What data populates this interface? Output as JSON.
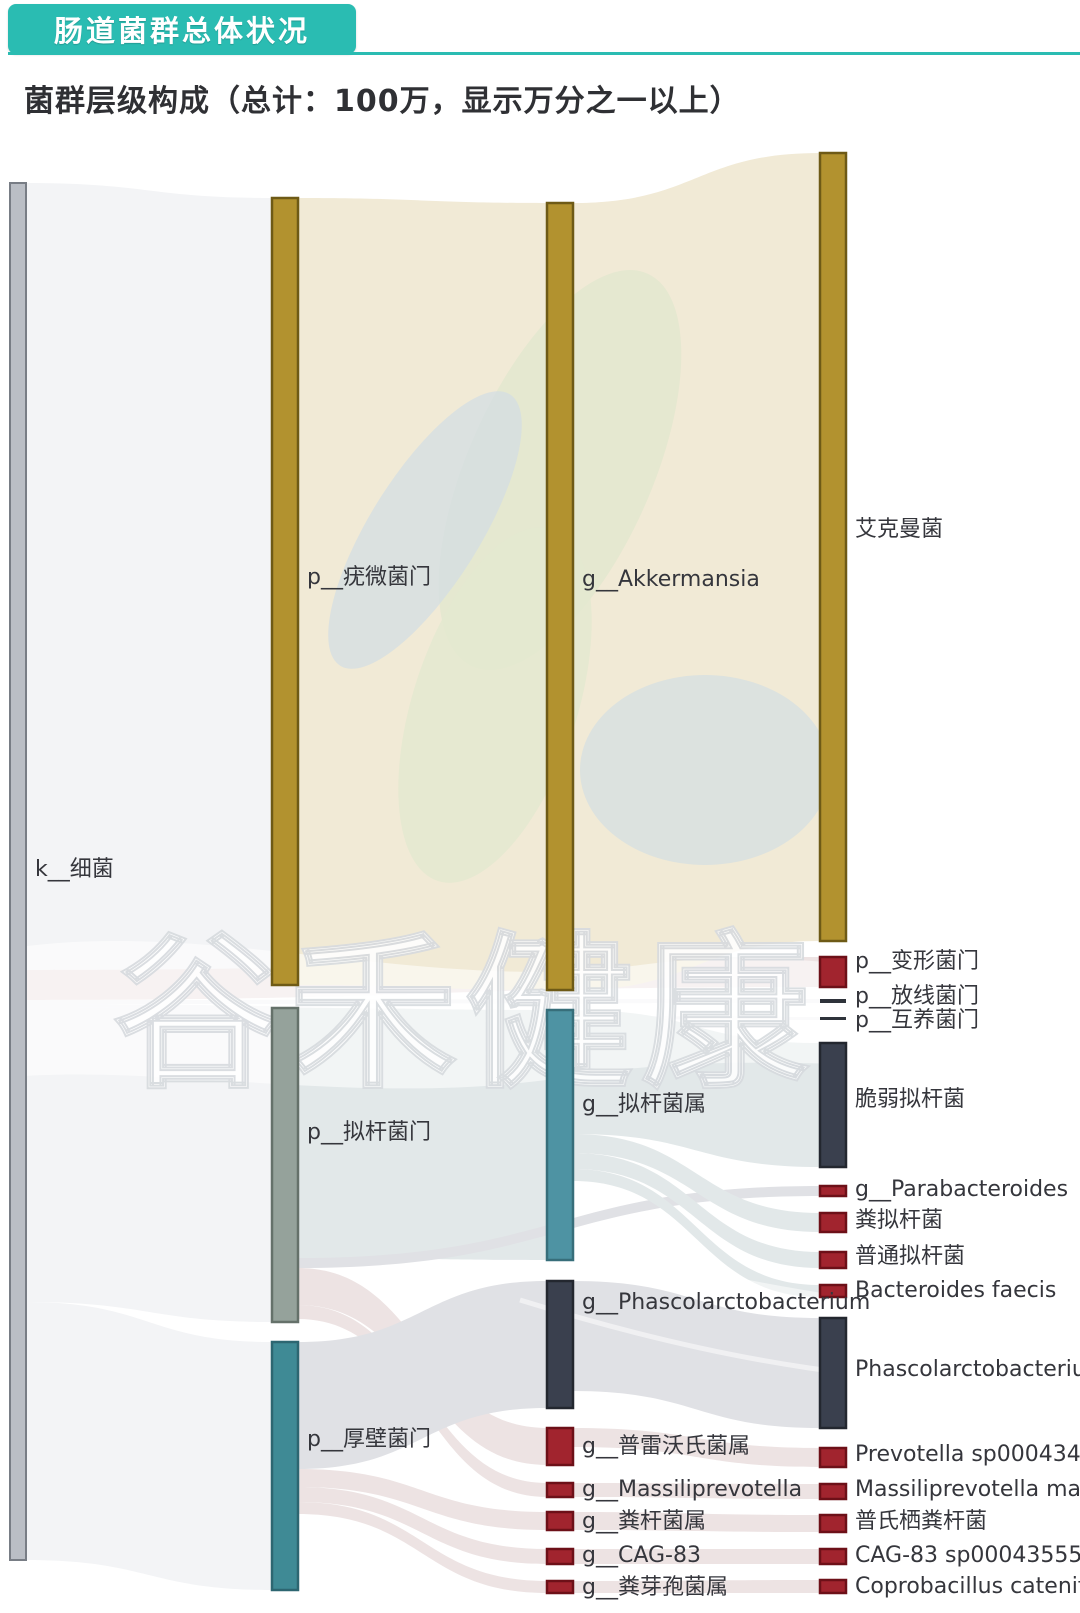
{
  "header": {
    "tab_title": "肠道菌群总体状况",
    "subtitle": "菌群层级构成（总计：100万，显示万分之一以上）"
  },
  "watermark": {
    "text": "谷禾健康"
  },
  "brand": {
    "teal": "#2abcb2",
    "gold": "#b2922f",
    "red": "#a1242e",
    "dark": "#3a404e"
  },
  "chart_data": {
    "type": "sankey",
    "title": "菌群层级构成（总计：100万，显示万分之一以上）",
    "total_label": "总计：100万",
    "threshold_label": "显示万分之一以上",
    "levels": [
      "kingdom",
      "phylum",
      "genus",
      "species"
    ],
    "palette": {
      "gray": "#babec5",
      "gray_stroke": "#787d85",
      "gold": "#b2922f",
      "gold_stroke": "#6e5a16",
      "sage": "#95a29b",
      "sage_stroke": "#65716a",
      "teal": "#3f8a95",
      "teal_stroke": "#2d6671",
      "teal2": "#4e93a3",
      "teal2_stroke": "#376e7a",
      "dark": "#3a404e",
      "dark_stroke": "#23272f",
      "red": "#a1242e",
      "red_stroke": "#6d1018",
      "darkline": "#2f333b",
      "flowGray": "#f3f4f6",
      "beige": "#f1ead6",
      "flowTeal": "#e2e8e9",
      "flowPink": "#ede3e3",
      "flowDark": "#e0e1e5"
    },
    "layout": {
      "columns": [
        {
          "x": 10,
          "w": 16
        },
        {
          "x": 272,
          "w": 26
        },
        {
          "x": 547,
          "w": 26
        },
        {
          "x": 820,
          "w": 26
        }
      ]
    },
    "nodes": [
      {
        "id": "k_bacteria",
        "label": "k__细菌",
        "col": 1,
        "y0": 183,
        "y1": 1560,
        "ly": 870,
        "color": "gray",
        "approx_share_pct": 100
      },
      {
        "id": "p_verruco",
        "label": "p__疣微菌门",
        "col": 2,
        "y0": 198,
        "y1": 985,
        "ly": 578,
        "color": "gold",
        "approx_share_pct": 57
      },
      {
        "id": "p_bacteroidetes",
        "label": "p__拟杆菌门",
        "col": 2,
        "y0": 1008,
        "y1": 1322,
        "ly": 1133,
        "color": "sage",
        "approx_share_pct": 23
      },
      {
        "id": "p_firmicutes",
        "label": "p__厚壁菌门",
        "col": 2,
        "y0": 1342,
        "y1": 1590,
        "ly": 1440,
        "color": "teal",
        "approx_share_pct": 18
      },
      {
        "id": "g_akkermansia",
        "label": "g__Akkermansia",
        "col": 3,
        "y0": 203,
        "y1": 990,
        "ly": 580,
        "color": "gold",
        "approx_share_pct": 57
      },
      {
        "id": "g_bacteroides",
        "label": "g__拟杆菌属",
        "col": 3,
        "y0": 1010,
        "y1": 1260,
        "ly": 1105,
        "color": "teal2",
        "approx_share_pct": 18
      },
      {
        "id": "g_phascolarcto",
        "label": "g__Phascolarctobacterium",
        "col": 3,
        "y0": 1281,
        "y1": 1408,
        "ly": 1303,
        "color": "dark",
        "approx_share_pct": 9.2
      },
      {
        "id": "g_prevotella",
        "label": "g__普雷沃氏菌属",
        "col": 3,
        "y0": 1428,
        "y1": 1465,
        "ly": 1447,
        "color": "red",
        "approx_share_pct": 2.7
      },
      {
        "id": "g_massiliprevotella",
        "label": "g__Massiliprevotella",
        "col": 3,
        "y0": 1483,
        "y1": 1497,
        "ly": 1490,
        "color": "red",
        "approx_share_pct": 1.0
      },
      {
        "id": "g_faecalibacterium",
        "label": "g__粪杆菌属",
        "col": 3,
        "y0": 1512,
        "y1": 1530,
        "ly": 1522,
        "color": "red",
        "approx_share_pct": 1.3
      },
      {
        "id": "g_cag83",
        "label": "g__CAG-83",
        "col": 3,
        "y0": 1549,
        "y1": 1564,
        "ly": 1556,
        "color": "red",
        "approx_share_pct": 1.1
      },
      {
        "id": "g_coprobacillus",
        "label": "g__粪芽孢菌属",
        "col": 3,
        "y0": 1581,
        "y1": 1593,
        "ly": 1588,
        "color": "red",
        "approx_share_pct": 0.9
      },
      {
        "id": "s_akkermansia",
        "label": "艾克曼菌",
        "col": 4,
        "y0": 153,
        "y1": 941,
        "ly": 530,
        "color": "gold",
        "approx_share_pct": 57
      },
      {
        "id": "p_proteobacteria",
        "label": "p__变形菌门",
        "col": 4,
        "y0": 957,
        "y1": 987,
        "ly": 962,
        "color": "red",
        "approx_share_pct": 2.2
      },
      {
        "id": "p_actinobacteria",
        "label": "p__放线菌门",
        "col": 4,
        "y0": 999,
        "y1": 1003,
        "ly": 997,
        "color": "darkline",
        "approx_share_pct": 0.3
      },
      {
        "id": "p_synergistetes",
        "label": "p__互养菌门",
        "col": 4,
        "y0": 1017,
        "y1": 1020,
        "ly": 1021,
        "color": "darkline",
        "approx_share_pct": 0.2
      },
      {
        "id": "s_fragilis",
        "label": "脆弱拟杆菌",
        "col": 4,
        "y0": 1043,
        "y1": 1167,
        "ly": 1100,
        "color": "dark",
        "approx_share_pct": 9
      },
      {
        "id": "g_parabacteroides",
        "label": "g__Parabacteroides",
        "col": 4,
        "y0": 1186,
        "y1": 1196,
        "ly": 1190,
        "color": "red",
        "approx_share_pct": 0.7
      },
      {
        "id": "s_caccae",
        "label": "粪拟杆菌",
        "col": 4,
        "y0": 1213,
        "y1": 1232,
        "ly": 1221,
        "color": "red",
        "approx_share_pct": 1.4
      },
      {
        "id": "s_vulgatus",
        "label": "普通拟杆菌",
        "col": 4,
        "y0": 1252,
        "y1": 1268,
        "ly": 1257,
        "color": "red",
        "approx_share_pct": 1.2
      },
      {
        "id": "s_faecis",
        "label": "Bacteroides faecis",
        "col": 4,
        "y0": 1285,
        "y1": 1297,
        "ly": 1291,
        "color": "red",
        "approx_share_pct": 0.9
      },
      {
        "id": "s_phascolarcto",
        "label": "Phascolarctobacteriu",
        "col": 4,
        "y0": 1318,
        "y1": 1428,
        "ly": 1370,
        "color": "dark",
        "approx_share_pct": 8
      },
      {
        "id": "s_prevotella_sp",
        "label": "Prevotella sp0004349",
        "col": 4,
        "y0": 1448,
        "y1": 1467,
        "ly": 1455,
        "color": "red",
        "approx_share_pct": 1.4
      },
      {
        "id": "s_massiliprevotella",
        "label": "Massiliprevotella mas",
        "col": 4,
        "y0": 1484,
        "y1": 1499,
        "ly": 1490,
        "color": "red",
        "approx_share_pct": 1.1
      },
      {
        "id": "s_prausnitzii",
        "label": "普氏栖粪杆菌",
        "col": 4,
        "y0": 1515,
        "y1": 1532,
        "ly": 1522,
        "color": "red",
        "approx_share_pct": 1.2
      },
      {
        "id": "s_cag83_sp",
        "label": "CAG-83 sp00043555",
        "col": 4,
        "y0": 1549,
        "y1": 1564,
        "ly": 1556,
        "color": "red",
        "approx_share_pct": 1.1
      },
      {
        "id": "s_coprobacillus",
        "label": "Coprobacillus catenif",
        "col": 4,
        "y0": 1580,
        "y1": 1593,
        "ly": 1587,
        "color": "red",
        "approx_share_pct": 0.9
      }
    ],
    "links": [
      {
        "source": "k_bacteria",
        "target": "p_verruco",
        "s0": 183,
        "s1": 970,
        "t0": 198,
        "t1": 985,
        "color": "flowGray"
      },
      {
        "source": "k_bacteria",
        "target": "p_proteobacteria",
        "s0": 970,
        "s1": 1000,
        "t0": 957,
        "t1": 987,
        "color": "flowPink"
      },
      {
        "source": "k_bacteria",
        "target": "p_actinobacteria",
        "s0": 1000,
        "s1": 1004,
        "t0": 999,
        "t1": 1003,
        "color": "flowGray"
      },
      {
        "source": "k_bacteria",
        "target": "p_synergistetes",
        "s0": 1004,
        "s1": 1007,
        "t0": 1017,
        "t1": 1020,
        "color": "flowGray"
      },
      {
        "source": "k_bacteria",
        "target": "p_bacteroidetes",
        "s0": 1007,
        "s1": 1302,
        "t0": 1008,
        "t1": 1322,
        "color": "flowGray"
      },
      {
        "source": "k_bacteria",
        "target": "p_firmicutes",
        "s0": 1302,
        "s1": 1560,
        "t0": 1342,
        "t1": 1590,
        "color": "flowGray"
      },
      {
        "source": "p_verruco",
        "target": "g_akkermansia",
        "s0": 198,
        "s1": 985,
        "t0": 203,
        "t1": 990,
        "color": "beige"
      },
      {
        "source": "g_akkermansia",
        "target": "s_akkermansia",
        "s0": 203,
        "s1": 990,
        "t0": 153,
        "t1": 941,
        "color": "beige"
      },
      {
        "source": "p_bacteroidetes",
        "target": "g_bacteroides",
        "s0": 1008,
        "s1": 1258,
        "t0": 1010,
        "t1": 1260,
        "color": "flowTeal"
      },
      {
        "source": "p_bacteroidetes",
        "target": "g_parabacteroides",
        "s0": 1258,
        "s1": 1268,
        "t0": 1186,
        "t1": 1196,
        "color": "flowDark"
      },
      {
        "source": "p_bacteroidetes",
        "target": "g_prevotella",
        "s0": 1268,
        "s1": 1305,
        "t0": 1428,
        "t1": 1465,
        "color": "flowPink"
      },
      {
        "source": "p_bacteroidetes",
        "target": "g_massiliprevotella",
        "s0": 1305,
        "s1": 1319,
        "t0": 1483,
        "t1": 1497,
        "color": "flowPink"
      },
      {
        "source": "p_firmicutes",
        "target": "g_phascolarcto",
        "s0": 1342,
        "s1": 1469,
        "t0": 1281,
        "t1": 1408,
        "color": "flowDark"
      },
      {
        "source": "p_firmicutes",
        "target": "g_faecalibacterium",
        "s0": 1469,
        "s1": 1487,
        "t0": 1512,
        "t1": 1530,
        "color": "flowPink"
      },
      {
        "source": "p_firmicutes",
        "target": "g_cag83",
        "s0": 1487,
        "s1": 1502,
        "t0": 1549,
        "t1": 1564,
        "color": "flowPink"
      },
      {
        "source": "p_firmicutes",
        "target": "g_coprobacillus",
        "s0": 1502,
        "s1": 1514,
        "t0": 1581,
        "t1": 1593,
        "color": "flowPink"
      },
      {
        "source": "g_bacteroides",
        "target": "s_fragilis",
        "s0": 1010,
        "s1": 1134,
        "t0": 1043,
        "t1": 1167,
        "color": "flowTeal"
      },
      {
        "source": "g_bacteroides",
        "target": "s_caccae",
        "s0": 1134,
        "s1": 1153,
        "t0": 1213,
        "t1": 1232,
        "color": "flowTeal"
      },
      {
        "source": "g_bacteroides",
        "target": "s_vulgatus",
        "s0": 1153,
        "s1": 1169,
        "t0": 1252,
        "t1": 1268,
        "color": "flowTeal"
      },
      {
        "source": "g_bacteroides",
        "target": "s_faecis",
        "s0": 1169,
        "s1": 1181,
        "t0": 1285,
        "t1": 1297,
        "color": "flowTeal"
      },
      {
        "source": "g_phascolarcto",
        "target": "s_phascolarcto",
        "s0": 1281,
        "s1": 1391,
        "t0": 1318,
        "t1": 1428,
        "color": "flowDark"
      },
      {
        "source": "g_prevotella",
        "target": "s_prevotella_sp",
        "s0": 1428,
        "s1": 1447,
        "t0": 1448,
        "t1": 1467,
        "color": "flowPink"
      },
      {
        "source": "g_massiliprevotella",
        "target": "s_massiliprevotella",
        "s0": 1483,
        "s1": 1497,
        "t0": 1484,
        "t1": 1499,
        "color": "flowPink"
      },
      {
        "source": "g_faecalibacterium",
        "target": "s_prausnitzii",
        "s0": 1512,
        "s1": 1530,
        "t0": 1515,
        "t1": 1532,
        "color": "flowPink"
      },
      {
        "source": "g_cag83",
        "target": "s_cag83_sp",
        "s0": 1549,
        "s1": 1564,
        "t0": 1549,
        "t1": 1564,
        "color": "flowPink"
      },
      {
        "source": "g_coprobacillus",
        "target": "s_coprobacillus",
        "s0": 1581,
        "s1": 1593,
        "t0": 1580,
        "t1": 1593,
        "color": "flowPink"
      }
    ]
  }
}
